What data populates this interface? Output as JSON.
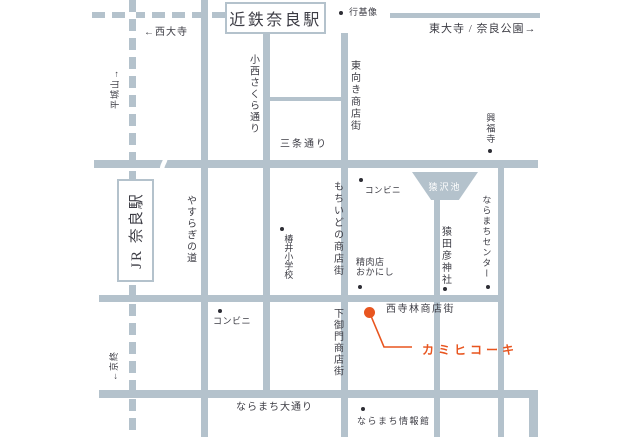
{
  "stations": {
    "kintetsu_nara": "近鉄奈良駅",
    "jr_nara": "JR 奈良駅"
  },
  "directions": {
    "to_saidaiji": "←西大寺",
    "to_narayama": "平城山→",
    "to_todaiji_nara_park": "東大寺 / 奈良公園→",
    "to_kyobate": "←京終"
  },
  "streets": {
    "konishi_sakura_dori": "小西さくら通り",
    "sanjo_dori": "三条通り",
    "higashimuki_shotengai": "東向き商店街",
    "mochiidono_shotengai": "もちいどの商店街",
    "yasuragi_no_michi": "やすらぎの道",
    "shimomikado_shotengai": "下御門商店街",
    "nishiterabayashi_shotengai": "西寺林商店街",
    "naramachi_odori": "ならまち大通り"
  },
  "pois": {
    "gyoki_statue": "行基像",
    "kofukuji": "興福寺",
    "conbini_upper": "コンビニ",
    "sarusawa_pond": "猿沢池",
    "naramachi_center": "ならまちセンター",
    "sarutahiko_shrine": "猿田彦神社",
    "seinikuten_line1": "精肉店",
    "seinikuten_line2": "おかにし",
    "tsubai_elementary": "椿井小学校",
    "conbini_lower": "コンビニ",
    "naramachi_info": "ならまち情報館"
  },
  "destination": {
    "name": "カミヒコーキ"
  },
  "colors": {
    "road": "#b4c2cc",
    "text": "#3c3c44",
    "accent": "#e8551f",
    "pond_label": "#ffffff",
    "background": "#ffffff"
  }
}
